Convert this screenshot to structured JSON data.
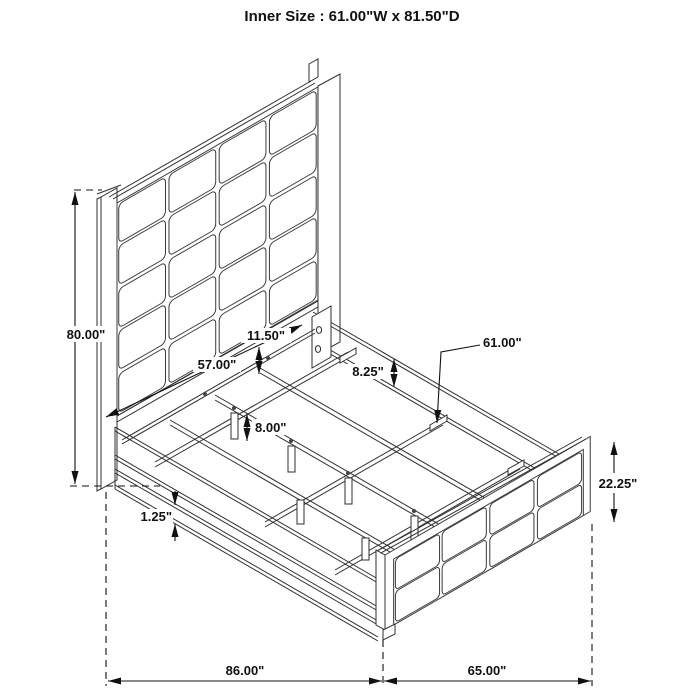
{
  "title": "Inner Size : 61.00\"W x 81.50\"D",
  "drawing": {
    "description": "Isometric line drawing of an upholstered panel bed assembly with dimension callouts",
    "line_color": "#2f2f2f",
    "dim_color": "#111111",
    "background": "#ffffff"
  },
  "dims": [
    {
      "id": "overall-height",
      "label": "80.00\""
    },
    {
      "id": "headboard-panel-width",
      "label": "57.00\""
    },
    {
      "id": "panel-row-height",
      "label": "11.50\""
    },
    {
      "id": "side-rail-height",
      "label": "8.25\""
    },
    {
      "id": "slat-inner-width",
      "label": "61.00\""
    },
    {
      "id": "support-leg-height",
      "label": "8.00\""
    },
    {
      "id": "rail-ledge-thickness",
      "label": "1.25\""
    },
    {
      "id": "footboard-height",
      "label": "22.25\""
    },
    {
      "id": "overall-depth",
      "label": "86.00\""
    },
    {
      "id": "overall-width",
      "label": "65.00\""
    }
  ]
}
